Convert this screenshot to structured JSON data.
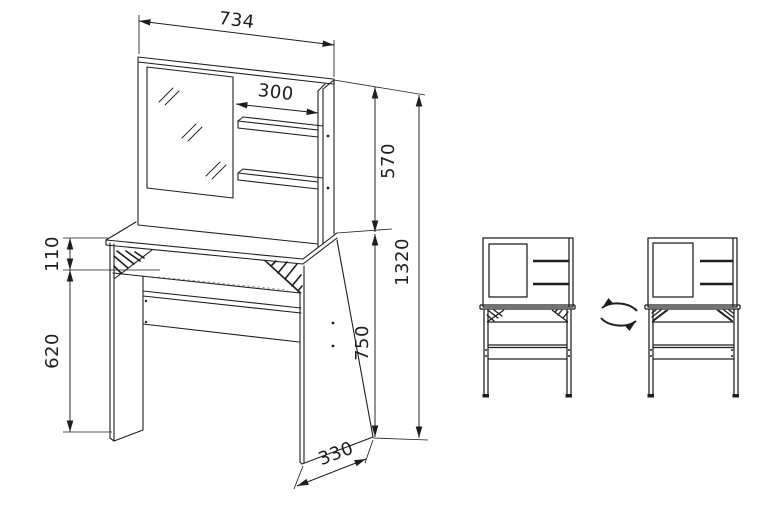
{
  "page": {
    "background": "#ffffff"
  },
  "drawing": {
    "line_color": "#1e1e1e",
    "type": "furniture assembly technical drawing",
    "subject": "dressing table with mirror, two shelves and drawer band",
    "dimensions_mm": {
      "overall_width": "734",
      "shelf_width": "300",
      "upper_section_height": "570",
      "total_height": "1320",
      "drawer_band_height": "110",
      "under_table_clearance": "620",
      "table_height": "750",
      "depth": "330"
    },
    "icons": {
      "rotation": "rotate-arrows-icon"
    }
  }
}
